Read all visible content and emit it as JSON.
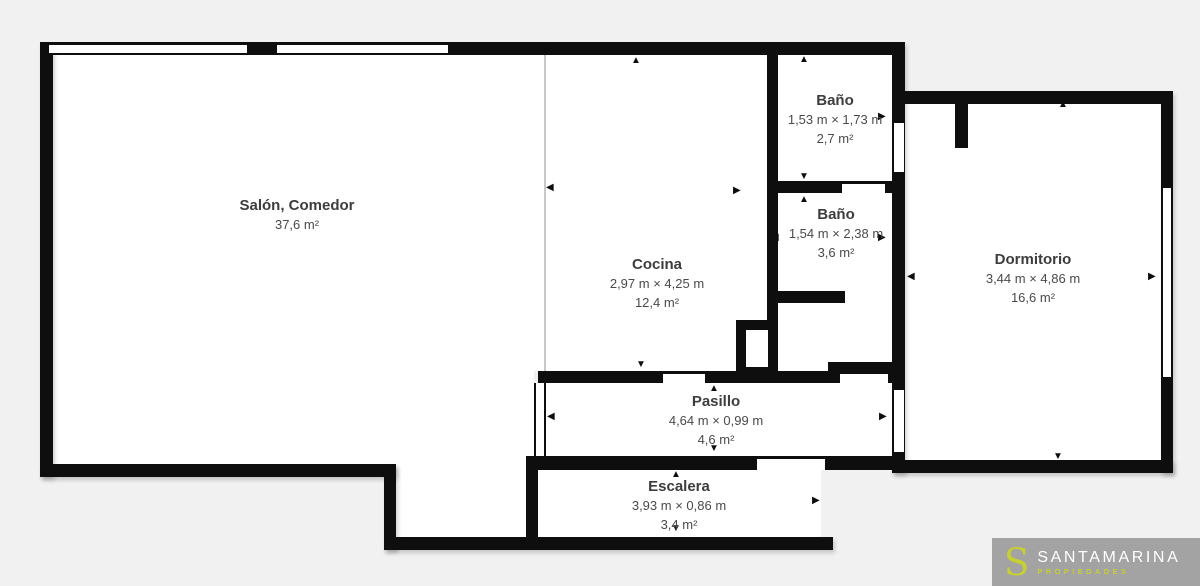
{
  "background": "#f1f1f1",
  "plan": {
    "wall_color": "#0e0e0e",
    "room_fill": "#ffffff",
    "text_color": "#3d3d3d",
    "text_secondary_color": "#4a4a4a",
    "divider_color": "#c8c8c8",
    "rooms": [
      {
        "id": "salon",
        "name": "Salón, Comedor",
        "dims": "",
        "area": "37,6 m²"
      },
      {
        "id": "cocina",
        "name": "Cocina",
        "dims": "2,97 m × 4,25 m",
        "area": "12,4 m²"
      },
      {
        "id": "bano1",
        "name": "Baño",
        "dims": "1,53 m × 1,73 m",
        "area": "2,7 m²"
      },
      {
        "id": "bano2",
        "name": "Baño",
        "dims": "1,54 m × 2,38 m",
        "area": "3,6 m²"
      },
      {
        "id": "dormitorio",
        "name": "Dormitorio",
        "dims": "3,44 m × 4,86 m",
        "area": "16,6 m²"
      },
      {
        "id": "pasillo",
        "name": "Pasillo",
        "dims": "4,64 m × 0,99 m",
        "area": "4,6 m²"
      },
      {
        "id": "escalera",
        "name": "Escalera",
        "dims": "3,93 m × 0,86 m",
        "area": "3,4 m²"
      }
    ]
  },
  "logo": {
    "initial": "S",
    "brand": "SANTAMARINA",
    "tagline": "PROPIEDADES",
    "background": "#a3a3a3",
    "accent": "#c6cf34",
    "brand_color": "#ffffff"
  }
}
